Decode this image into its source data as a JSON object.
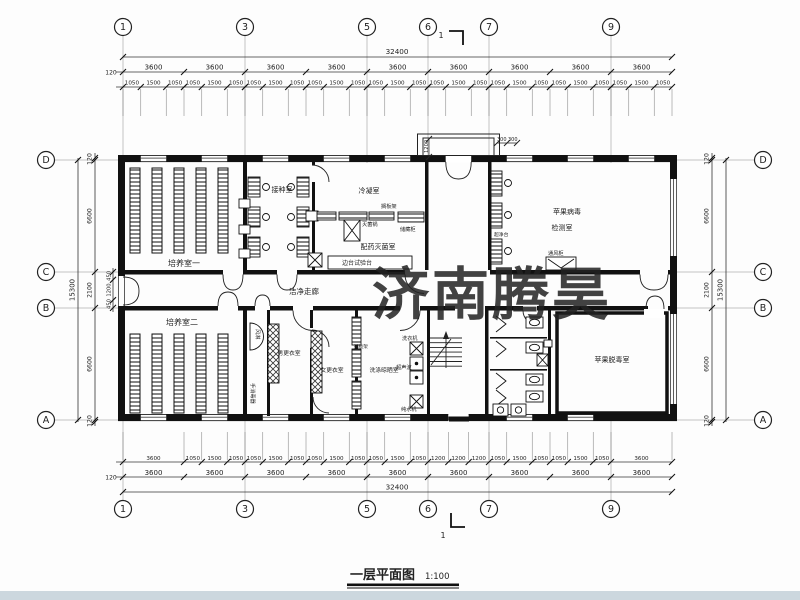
{
  "title": {
    "text": "一层平面图",
    "scale": "1:100"
  },
  "watermark": {
    "text": "济南腾昊",
    "color": "#d9342c"
  },
  "section": {
    "label": "1"
  },
  "footer": {
    "color": "#ccd7de"
  },
  "grid": {
    "cols": [
      {
        "label": "1",
        "x": 123
      },
      {
        "label": "3",
        "x": 245
      },
      {
        "label": "5",
        "x": 367
      },
      {
        "label": "6",
        "x": 428
      },
      {
        "label": "7",
        "x": 489
      },
      {
        "label": "9",
        "x": 611
      }
    ],
    "rows": [
      {
        "label": "D",
        "y": 160
      },
      {
        "label": "C",
        "y": 272
      },
      {
        "label": "B",
        "y": 308
      },
      {
        "label": "A",
        "y": 420
      }
    ]
  },
  "dims": {
    "total": "32400",
    "side_total": "15300",
    "margin": "120",
    "top_bays": [
      3600,
      3600,
      3600,
      3600,
      3600,
      3600,
      3600,
      3600,
      3600
    ],
    "top_sub": [
      [
        1050,
        1500,
        1050
      ],
      [
        1050,
        1500,
        1050
      ],
      [
        1050,
        1500,
        1050
      ],
      [
        1050,
        1500,
        1050
      ],
      [
        1050,
        1500,
        1050
      ],
      [
        1050,
        1500,
        1050
      ],
      [
        1050,
        1500,
        1050
      ],
      [
        1050,
        1500,
        1050
      ],
      [
        1050,
        1500,
        1050
      ]
    ],
    "bottom_bays": [
      3600,
      3600,
      3600,
      3600,
      3600,
      3600,
      3600,
      3600,
      3600
    ],
    "bottom_sub": [
      [
        3600
      ],
      [
        1050,
        1500,
        1050
      ],
      [
        1050,
        1500,
        1050
      ],
      [
        1050,
        1500,
        1050
      ],
      [
        1050,
        1500,
        1050
      ],
      [
        1200,
        1200,
        1200
      ],
      [
        1050,
        1500,
        1050
      ],
      [
        1050,
        1500,
        1050
      ],
      [
        3600
      ]
    ],
    "left_chain": [
      "120",
      "6600",
      "2100",
      "6600",
      "120"
    ],
    "left_inner": [
      "450",
      "1200",
      "450"
    ],
    "right_chain": [
      "120",
      "6600",
      "2100",
      "6600",
      "120"
    ]
  },
  "rooms": [
    {
      "t": "培养室一",
      "x": 184,
      "y": 266,
      "s": 8
    },
    {
      "t": "接种室",
      "x": 282,
      "y": 192,
      "s": 7
    },
    {
      "t": "冷凝室",
      "x": 369,
      "y": 193,
      "s": 7
    },
    {
      "t": "配药灭菌室",
      "x": 378,
      "y": 249,
      "s": 7
    },
    {
      "t": "苹果病毒",
      "x": 567,
      "y": 214,
      "s": 7
    },
    {
      "t": "检测室",
      "x": 562,
      "y": 230,
      "s": 7
    },
    {
      "t": "洁净走廊",
      "x": 304,
      "y": 294,
      "s": 7.5
    },
    {
      "t": "培养室二",
      "x": 182,
      "y": 325,
      "s": 8
    },
    {
      "t": "男更衣室",
      "x": 289,
      "y": 355,
      "s": 5.8
    },
    {
      "t": "女更衣室",
      "x": 332,
      "y": 372,
      "s": 5.8
    },
    {
      "t": "洗涤晾晒室",
      "x": 384,
      "y": 372,
      "s": 5.8
    },
    {
      "t": "苹果脱毒室",
      "x": 612,
      "y": 362,
      "s": 7
    }
  ],
  "labels": [
    {
      "t": "搁板架",
      "x": 381,
      "y": 208,
      "s": 5.2
    },
    {
      "t": "灭菌锅",
      "x": 362,
      "y": 226,
      "s": 5.2
    },
    {
      "t": "储藏柜",
      "x": 400,
      "y": 231,
      "s": 5.2
    },
    {
      "t": "边台试验台",
      "x": 342,
      "y": 265,
      "s": 6
    },
    {
      "t": "超净台",
      "x": 494,
      "y": 236,
      "s": 4.8
    },
    {
      "t": "通风柜",
      "x": 548,
      "y": 255,
      "s": 5.2
    },
    {
      "t": "洗衣机",
      "x": 402,
      "y": 340,
      "s": 5.2
    },
    {
      "t": "超声波",
      "x": 396,
      "y": 369,
      "s": 5.2
    },
    {
      "t": "纯水机",
      "x": 401,
      "y": 411,
      "s": 5.2
    },
    {
      "t": "搁板架",
      "x": 354,
      "y": 348,
      "s": 4.6
    },
    {
      "t": "风淋",
      "x": 256,
      "y": 329,
      "s": 5.2,
      "rot": 90
    },
    {
      "t": "手消毒器",
      "x": 251,
      "y": 383,
      "s": 5.2,
      "rot": 90
    },
    {
      "t": "1200",
      "x": 428,
      "y": 153,
      "s": 5.2,
      "rot": -90
    },
    {
      "t": "300",
      "x": 497,
      "y": 141,
      "s": 5
    },
    {
      "t": "300",
      "x": 508,
      "y": 141,
      "s": 5
    }
  ]
}
